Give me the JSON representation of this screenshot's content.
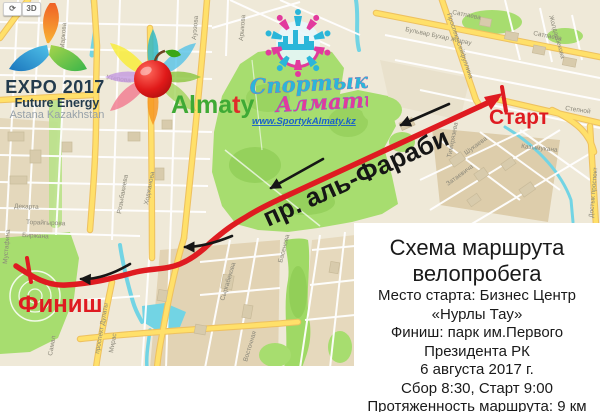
{
  "map_controls": {
    "compass_icon": "⟳",
    "mode_3d": "3D"
  },
  "logos": {
    "expo": {
      "title": "EXPO 2017",
      "subtitle": "Future Energy",
      "tagline": "Astana Kazakhstan"
    },
    "almaty": {
      "part1": "Alma",
      "part2": "t",
      "part3": "y"
    },
    "sportyk": {
      "word1": "Спортык",
      "word2": "Алматы",
      "website": "www.SportykAlmaty.kz"
    }
  },
  "route": {
    "start_label": "Старт",
    "finish_label": "Финиш",
    "street_label": "пр. аль-Фараби",
    "color": "#df1b21",
    "direction": "from Старт (northeast) to Финиш (southwest)"
  },
  "info_box": {
    "title_line1": "Схема маршрута",
    "title_line2": "велопробега",
    "lines": [
      "Место старта: Бизнес Центр",
      "«Нурлы Тау»",
      "Финиш: парк им.Первого",
      "Президента РК",
      "6 августа 2017 г.",
      "Сбор 8:30, Старт 9:00",
      "Протяженность маршрута: 9 км"
    ]
  },
  "map": {
    "colors": {
      "block": "#efe9d8",
      "block_dark": "#ddcdab",
      "road_major": "#ffe06a",
      "road_casing": "#eec15f",
      "park": "#a7dd6f",
      "water": "#72d4e4",
      "building": "#d8cbac",
      "label": "#8b887a",
      "route_red": "#df1b21"
    },
    "street_labels": [
      {
        "text": "Сатпаева",
        "x": 452,
        "y": 14,
        "rot": 11
      },
      {
        "text": "Сатпаева",
        "x": 533,
        "y": 35,
        "rot": 11
      },
      {
        "text": "Бульвар Бухар Жырау",
        "x": 405,
        "y": 31,
        "rot": 12
      },
      {
        "text": "Проспект Сейфуллина",
        "x": 447,
        "y": 14,
        "rot": 71
      },
      {
        "text": "Жолдасбекова",
        "x": 549,
        "y": 16,
        "rot": 74
      },
      {
        "text": "Степной",
        "x": 565,
        "y": 110,
        "rot": 8
      },
      {
        "text": "Казымукана",
        "x": 521,
        "y": 148,
        "rot": 6
      },
      {
        "text": "Затаевича",
        "x": 448,
        "y": 186,
        "rot": -36
      },
      {
        "text": "Шукаева",
        "x": 466,
        "y": 155,
        "rot": -36
      },
      {
        "text": "Достык проспект",
        "x": 593,
        "y": 218,
        "rot": -85
      },
      {
        "text": "Тимирязева",
        "x": 451,
        "y": 158,
        "rot": -79
      },
      {
        "text": "Ауэзова",
        "x": 196,
        "y": 40,
        "rot": -85
      },
      {
        "text": "Арыкова",
        "x": 243,
        "y": 41,
        "rot": -85
      },
      {
        "text": "Маркова",
        "x": 64,
        "y": 49,
        "rot": -85
      },
      {
        "text": "Утепова",
        "x": 106,
        "y": 79,
        "rot": 8
      },
      {
        "text": "Ходжанова",
        "x": 148,
        "y": 205,
        "rot": -79
      },
      {
        "text": "Розыбакиева",
        "x": 121,
        "y": 214,
        "rot": -80
      },
      {
        "text": "Декарта",
        "x": 14,
        "y": 208,
        "rot": 2
      },
      {
        "text": "Торайгырова",
        "x": 26,
        "y": 224,
        "rot": 2
      },
      {
        "text": "Биржана",
        "x": 22,
        "y": 237,
        "rot": 3
      },
      {
        "text": "Мустафина",
        "x": 7,
        "y": 264,
        "rot": -85
      },
      {
        "text": "проспект Дулаты",
        "x": 99,
        "y": 354,
        "rot": -80
      },
      {
        "text": "Самал",
        "x": 52,
        "y": 356,
        "rot": -80
      },
      {
        "text": "Мирас",
        "x": 113,
        "y": 353,
        "rot": -80
      },
      {
        "text": "Басенова",
        "x": 282,
        "y": 263,
        "rot": -75
      },
      {
        "text": "Сыргабекова",
        "x": 224,
        "y": 301,
        "rot": -73
      },
      {
        "text": "Восточная",
        "x": 247,
        "y": 362,
        "rot": -73
      }
    ]
  }
}
